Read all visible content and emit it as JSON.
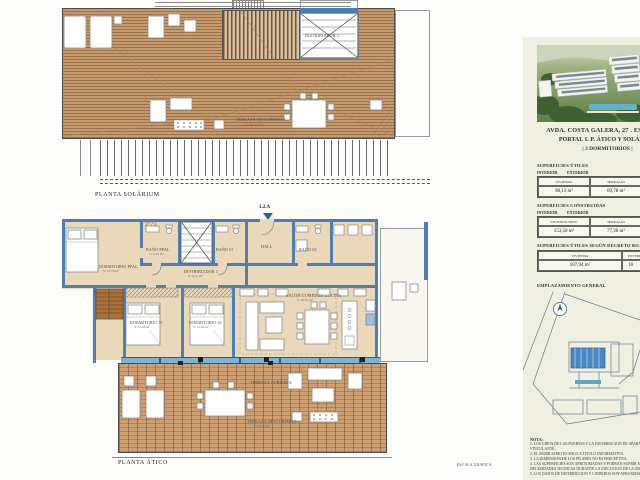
{
  "solarium": {
    "plan_label": "PLANTA SOLÁRIUM",
    "stair_label": "DISTRIBUIDOR 2",
    "terrace_label": "TERRAZA DESCUBIERTA",
    "terrace_area": "S: 100,97 m²"
  },
  "atico": {
    "plan_label": "PLANTA ÁTICO",
    "unit_code": "1.2.A",
    "rooms": {
      "dormitorio_ppal": {
        "name": "DORMITORIO PPAL",
        "area": "S: 13,78 m²"
      },
      "bano_ppal": {
        "name": "BAÑO PPAL",
        "area": "S: 5,16 m²"
      },
      "bano_01": {
        "name": "BAÑO 01"
      },
      "bano_02": {
        "name": "BAÑO 02"
      },
      "hall": {
        "name": "HALL"
      },
      "distribuidor": {
        "name": "DISTRIBUIDOR 1",
        "area": "S: 4,21 m²"
      },
      "dormitorio_01": {
        "name": "DORMITORIO 01",
        "area": "S: 11,08 m²"
      },
      "dormitorio_02": {
        "name": "DORMITORIO 02",
        "area": "S: 11,61 m²"
      },
      "salon": {
        "name": "SALON-COMEDOR-COCINA",
        "area": "S: 40,05 m²"
      },
      "terraza_cubierta": {
        "name": "TERRAZA CUBIERTA"
      },
      "terraza_descubierta": {
        "name": "TERRAZA DESCUBIERTA",
        "area": "S: 27,07 m²"
      }
    }
  },
  "scale": {
    "label": "ESCALA GRAFICA"
  },
  "panel": {
    "address_line1": "AVDA. COSTA GALERA, 27 . ESTEPONA",
    "address_line2": "PORTAL 1. P. ÁTICO Y SOLÁRIUM",
    "address_line3": "| 3 DORMITORIOS |",
    "sections": [
      {
        "title": "SUPERFICIES ÚTILES",
        "left": "INTERIOR",
        "right": "EXTERIOR",
        "columns": [
          "VIVIENDA",
          "TERRAZAS",
          "SOLARIUM"
        ],
        "values": [
          "98,13 m²",
          "69,78 m²",
          "100,97 m²"
        ]
      },
      {
        "title": "SUPERFICIES CONSTRUIDAS",
        "left": "INTERIOR",
        "right": "EXTERIOR",
        "columns": [
          "VIVIENDA+PPZC",
          "TERRAZAS",
          "SOLARIUM"
        ],
        "values": [
          "153,50 m²",
          "77,36 m²",
          "113,37 m²"
        ]
      },
      {
        "title": "SUPERFICIES ÚTILES SEGÚN DECRETO BOJA 218/2005",
        "columns": [
          "VIVIENDA",
          "EXTERIOR"
        ],
        "values": [
          "107,94 m²",
          "18"
        ]
      }
    ],
    "site_plan_title": "EMPLAZAMIENTO GENERAL",
    "nota_title": "NOTA:",
    "nota_lines": [
      "1. LOS GIROS DE LAS PUERTAS Y LA DISTRIBUCION DE APARATOS SANITARIOS NO ES VINCULANTE.",
      "2. EL MOBILIARIO ES SOLO A TITULO INFORMATIVO.",
      "3. LA DIMENSION DE LOS PILARES NO ES PRECEPTIVA.",
      "4. LAS SUPERFICIES SON APROXIMADAS Y PODRÁN SUFRIR MODIFICACIONES POR NECESIDADES TECNICAS DURANTE LA EJECUCION DE LA OBRA.",
      "5. LOS DATOS DE DISTRIBUCION Y LINDEROS SON APROXIMADOS."
    ]
  }
}
